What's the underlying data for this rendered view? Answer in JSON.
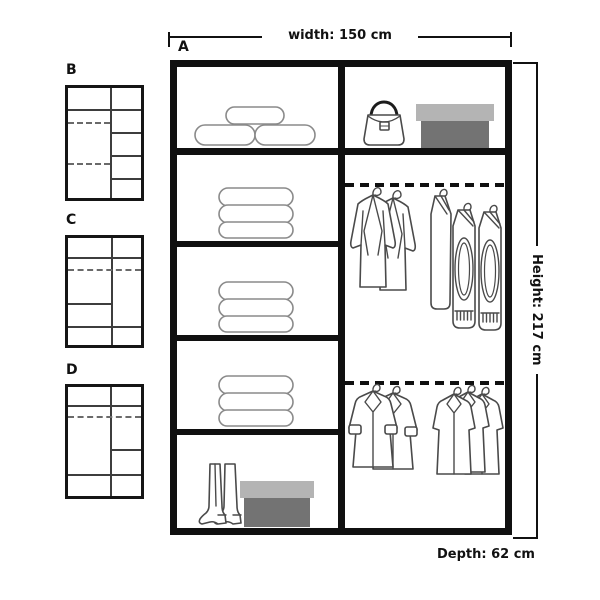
{
  "measurements": {
    "width_label": "width: 150 cm",
    "height_label": "Height: 217 cm",
    "depth_label": "Depth: 62 cm"
  },
  "main_unit": {
    "label": "A",
    "left_column_contents": [
      "rolled-duvets",
      "folded-clothes-stack",
      "folded-clothes-stack",
      "folded-clothes-stack",
      "boots-and-shoebox"
    ],
    "right_column_contents": [
      "handbag-and-shoebox",
      "hanging-rail-with-jackets-and-sweaters",
      "hanging-rail-with-coats"
    ]
  },
  "variants": [
    {
      "label": "B"
    },
    {
      "label": "C"
    },
    {
      "label": "D"
    }
  ],
  "colors": {
    "frame_line": "#101010",
    "sketch_stroke": "#4a4a4a",
    "soft_stroke": "#8a8a8a",
    "shoebox_lid": "#b4b4b4",
    "shoebox_body": "#737373",
    "background": "#ffffff"
  }
}
